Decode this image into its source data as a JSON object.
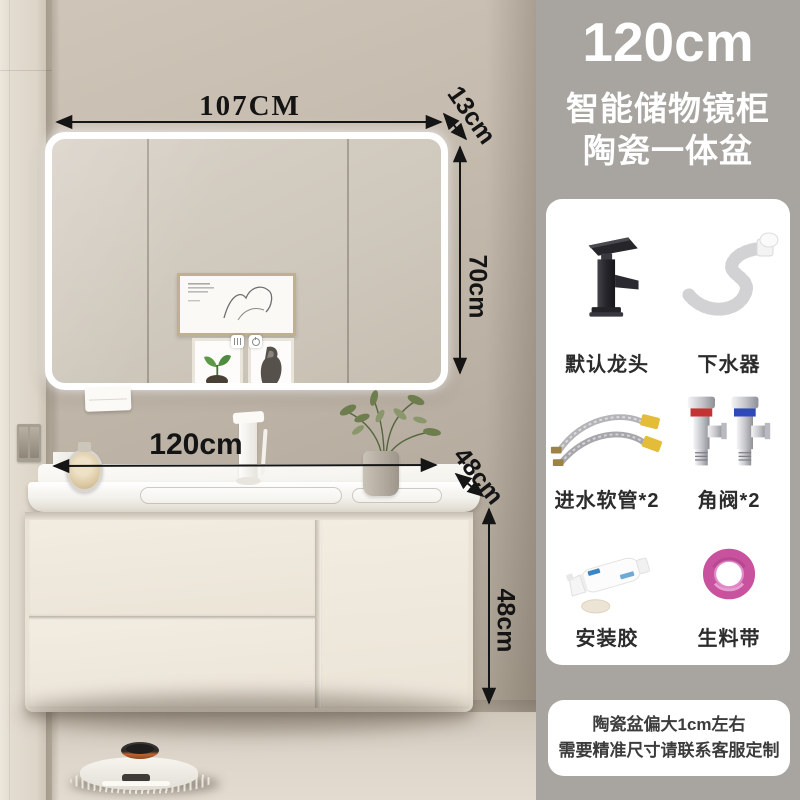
{
  "header": {
    "size_title": "120cm",
    "subtitle_line1": "智能储物镜柜",
    "subtitle_line2": "陶瓷一体盆"
  },
  "scene": {
    "dimensions": {
      "mirror_width": "107CM",
      "mirror_depth": "13cm",
      "mirror_height": "70cm",
      "vanity_width": "120cm",
      "vanity_depth": "48cm",
      "vanity_height": "48cm"
    }
  },
  "accessories": {
    "items": [
      {
        "label": "默认龙头",
        "icon": "faucet-icon"
      },
      {
        "label": "下水器",
        "icon": "drain-pipe-icon"
      },
      {
        "label": "进水软管*2",
        "icon": "inlet-hose-icon"
      },
      {
        "label": "角阀*2",
        "icon": "angle-valve-icon"
      },
      {
        "label": "安装胶",
        "icon": "adhesive-icon"
      },
      {
        "label": "生料带",
        "icon": "thread-seal-tape-icon"
      }
    ]
  },
  "note": {
    "line1": "陶瓷盆偏大1cm左右",
    "line2": "需要精准尺寸请联系客服定制"
  },
  "colors": {
    "gray_band": "#a8a5a1",
    "wall": "#b7ada0",
    "cabinet": "#ece5d9",
    "tape_pink": "#c9529f",
    "valve_red": "#c23434",
    "valve_blue": "#2f49b8"
  }
}
